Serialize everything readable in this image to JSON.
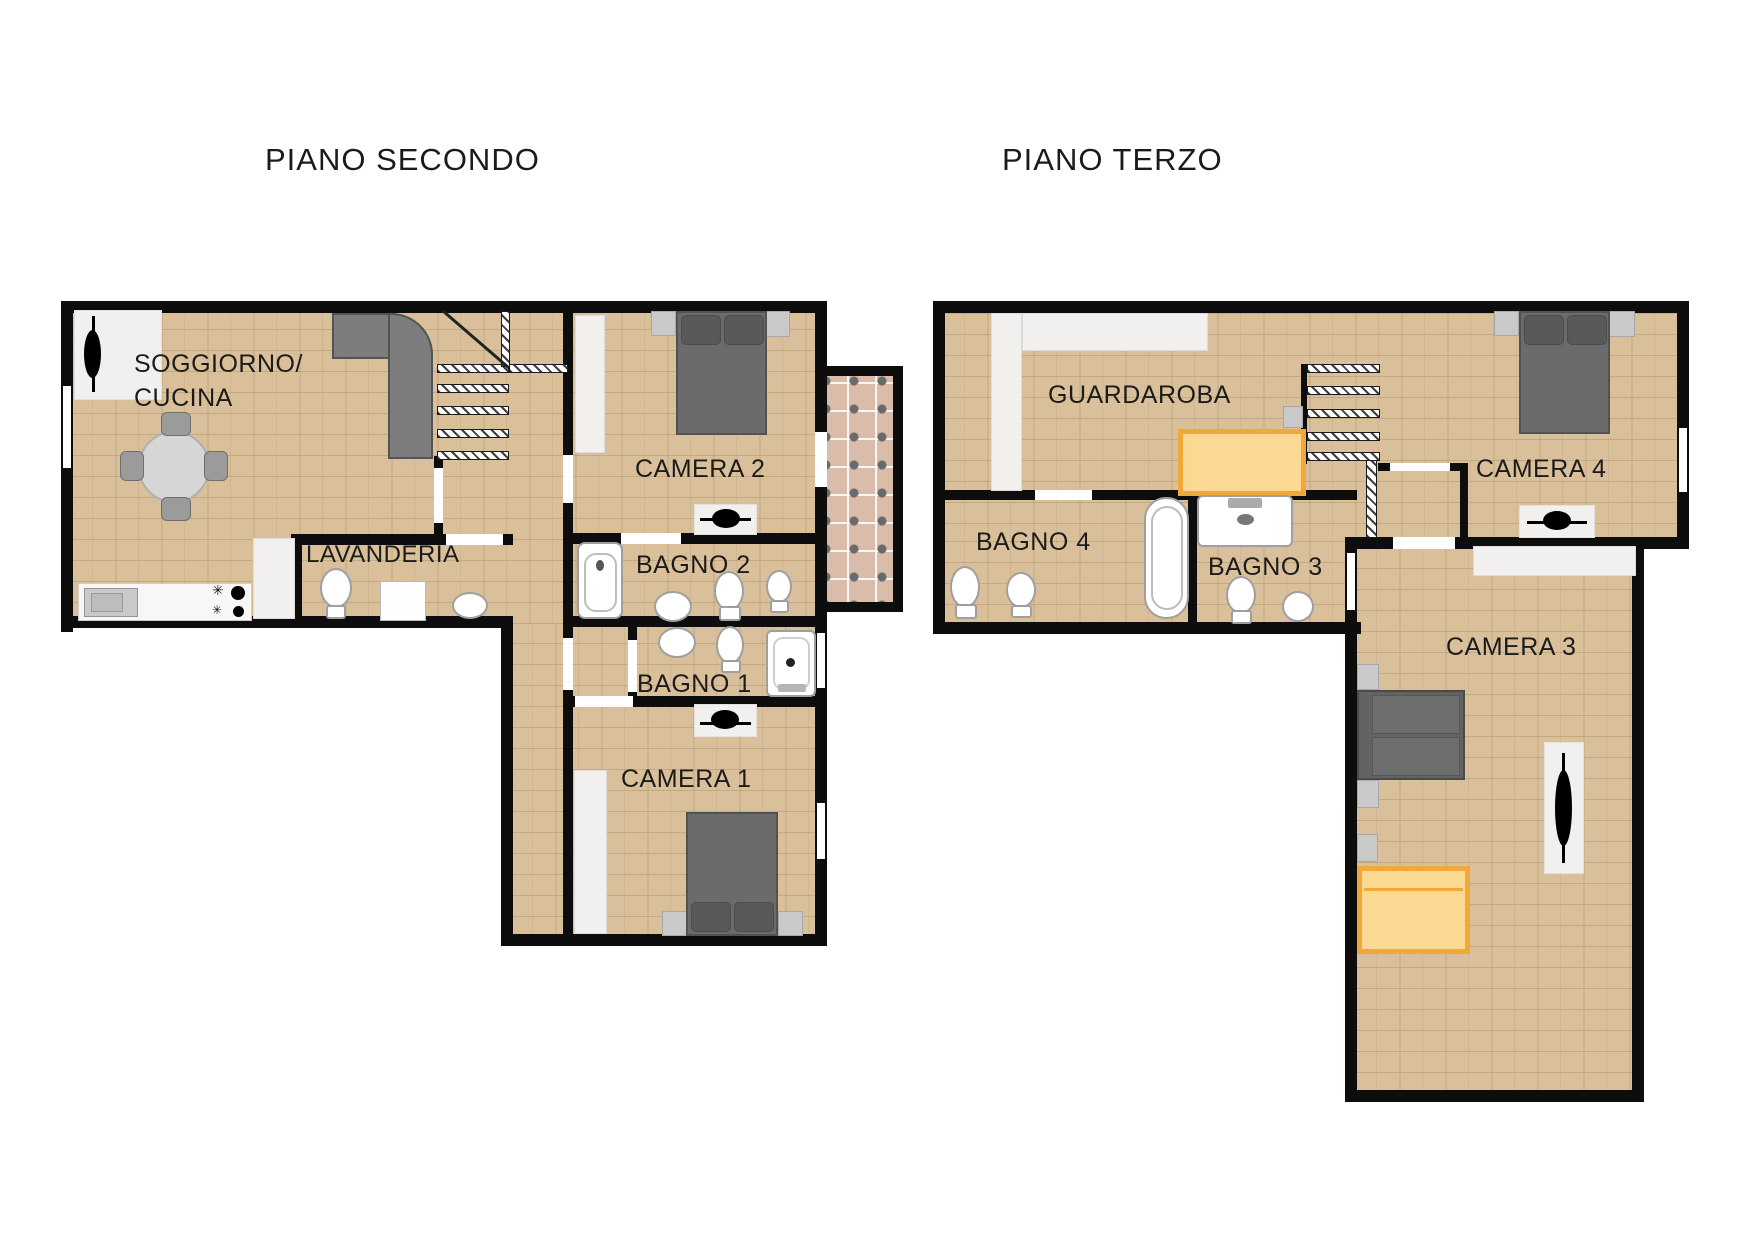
{
  "plans": [
    {
      "title": "PIANO SECONDO",
      "rooms": [
        {
          "key": "soggiorno_cucina",
          "label_line1": "SOGGIORNO/",
          "label_line2": "CUCINA"
        },
        {
          "key": "lavanderia",
          "label": "LAVANDERIA"
        },
        {
          "key": "camera2",
          "label": "CAMERA 2"
        },
        {
          "key": "bagno2",
          "label": "BAGNO 2"
        },
        {
          "key": "bagno1",
          "label": "BAGNO 1"
        },
        {
          "key": "camera1",
          "label": "CAMERA 1"
        }
      ]
    },
    {
      "title": "PIANO TERZO",
      "rooms": [
        {
          "key": "guardaroba",
          "label": "GUARDAROBA"
        },
        {
          "key": "bagno4",
          "label": "BAGNO 4"
        },
        {
          "key": "bagno3",
          "label": "BAGNO 3"
        },
        {
          "key": "camera4",
          "label": "CAMERA 4"
        },
        {
          "key": "camera3",
          "label": "CAMERA 3"
        }
      ]
    }
  ],
  "theme": {
    "background": "#ffffff",
    "wall_color": "#0d0d0d",
    "floor_color": "#d9c09a",
    "floor_line_color": "#b08d5f",
    "balcony_tile_color": "#d9bca9",
    "furniture_dark_gray": "#6b6b6b",
    "furniture_light_gray": "#c9c9c9",
    "closet_white": "#f1f0ee",
    "accent_orange_border": "#f0a83a",
    "accent_orange_fill": "#fbd993",
    "label_color": "#1b1b1b"
  },
  "icons": {
    "tv-icon": "black lens on white media shelf",
    "bed-icon": "gray double bed with two pillows and nightstands",
    "sofa-icon": "gray L-shaped corner sofa",
    "dining-table-icon": "round gray table with four chairs",
    "toilet-icon": "oval bowl with small tank",
    "bidet-icon": "small oval fixture",
    "sink-icon": "oval basin",
    "vanity-sink-icon": "rectangular basin with faucet",
    "bathtub-icon": "rounded white tub",
    "shower-icon": "square shower tray with drain dot",
    "washing-machine-icon": "white appliance square",
    "stove-icon": "two burner plates and two grates",
    "kitchen-sink-icon": "gray double basin",
    "stairs-icon": "hatched treads with diagonal stringer",
    "wardrobe-icon": "white built-in closet strip",
    "orange-wardrobe-icon": "orange highlighted wardrobe",
    "orange-bed-icon": "orange highlighted bed",
    "balcony-icon": "checkered tile terrace",
    "door-opening": "white gap in wall",
    "window-opening": "white strip in outer wall"
  }
}
